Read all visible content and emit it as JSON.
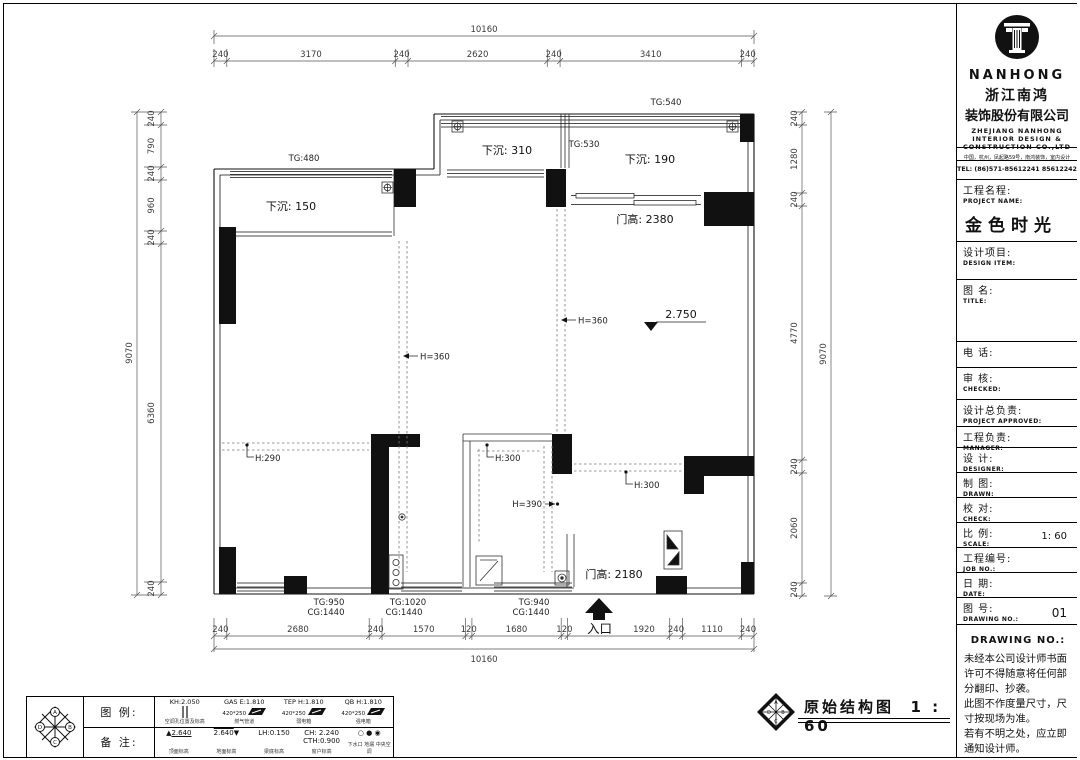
{
  "plan": {
    "labels": {
      "tg540": "TG:540",
      "tg530": "TG:530",
      "tg480": "TG:480",
      "sunken310": "下沉: 310",
      "sunken190": "下沉: 190",
      "sunken150": "下沉: 150",
      "door_h_2380": "门高: 2380",
      "door_h_2180": "门高: 2180",
      "level": "2.750",
      "h360": "H=360",
      "h290": "H:290",
      "h300": "H:300",
      "h390": "H=390",
      "entry": "入口"
    },
    "window_tags": {
      "w1_tg": "TG:950",
      "w1_cg": "CG:1440",
      "w2_tg": "TG:1020",
      "w2_cg": "CG:1440",
      "w3_tg": "TG:940",
      "w3_cg": "CG:1440"
    },
    "dims": {
      "top_total": "10160",
      "top": [
        "240",
        "3170",
        "240",
        "2620",
        "240",
        "3410",
        "240"
      ],
      "bottom": [
        "240",
        "2680",
        "240",
        "1570",
        "120",
        "1680",
        "120",
        "1920",
        "240",
        "1110",
        "240"
      ],
      "bottom_total": "10160",
      "left": [
        "240",
        "790",
        "240",
        "960",
        "240",
        "6360",
        "240"
      ],
      "left_total": "9070",
      "right": [
        "240",
        "1280",
        "240",
        "4770",
        "240",
        "2060",
        "240"
      ],
      "right_total": "9070"
    }
  },
  "legend_table": {
    "row1_label": "图 例:",
    "row2_label": "备 注:",
    "legend_items": [
      {
        "line1": "KH:2.050",
        "line2": "",
        "caption": "空调孔位置及标高"
      },
      {
        "line1": "GAS E:1.810",
        "line2": "420*250",
        "caption": "燃气管道"
      },
      {
        "line1": "TEP H:1.810",
        "line2": "420*250",
        "caption": "弱电箱"
      },
      {
        "line1": "QB H:1.810",
        "line2": "420*250",
        "caption": "强电箱"
      }
    ],
    "note_items": [
      {
        "value": "2.640",
        "caption": "顶面标高"
      },
      {
        "value": "2.640",
        "caption": "地面标高"
      },
      {
        "value": "LH:0.150",
        "caption": "梁底标高"
      },
      {
        "value": "CH: 2.240",
        "value2": "CTH:0.900",
        "caption": "窗户标高"
      },
      {
        "symbols": "○ ● ◉",
        "caption": "下水口 地漏 中央空调"
      }
    ]
  },
  "stamp": {
    "title": "原始结构图",
    "scale": "1 : 60"
  },
  "title_block": {
    "logo_text": "NANHONG",
    "company_cn_1": "浙江南鸿",
    "company_cn_2": "装饰股份有限公司",
    "company_en_1": "ZHEJIANG NANHONG",
    "company_en_2": "INTERIOR DESIGN &",
    "company_en_3": "CONSTRUCTION CO.,LTD",
    "address": "中国，杭州，凤起路59号，南鸿装饰，室内设计",
    "tel": "TEL: (86)571-85612241  85612242",
    "project_cn": "工程名程:",
    "project_en": "PROJECT NAME:",
    "project_value": "金色时光",
    "fields": [
      {
        "cn": "设计项目:",
        "en": "DESIGN ITEM:"
      },
      {
        "cn": "图  名:",
        "en": "TITLE:"
      },
      {
        "cn": "电    话:",
        "en": ""
      },
      {
        "cn": "审    核:",
        "en": "CHECKED:"
      },
      {
        "cn": "设计总负责:",
        "en": "PROJECT APPROVED:"
      },
      {
        "cn": "工程负责:",
        "en": "MANAGER:"
      },
      {
        "cn": "设    计:",
        "en": "DESIGNER:"
      },
      {
        "cn": "制    图:",
        "en": "DRAWN:"
      },
      {
        "cn": "校    对:",
        "en": "CHECK:"
      },
      {
        "cn": "比    例:",
        "en": "SCALE:",
        "value": "1: 60"
      },
      {
        "cn": "工程编号:",
        "en": "JOB NO.:"
      },
      {
        "cn": "日    期:",
        "en": "DATE:"
      },
      {
        "cn": "图    号:",
        "en": "DRAWING NO.:",
        "value": "01"
      }
    ],
    "notice_title": "DRAWING NO.:",
    "notice_lines": [
      "未经本公司设计师书面",
      "许可不得随意将任何部",
      "分翻印、抄袭。",
      "此图不作度量尺寸，尺",
      "寸按现场为准。",
      "若有不明之处，应立即",
      "通知设计师。"
    ]
  }
}
